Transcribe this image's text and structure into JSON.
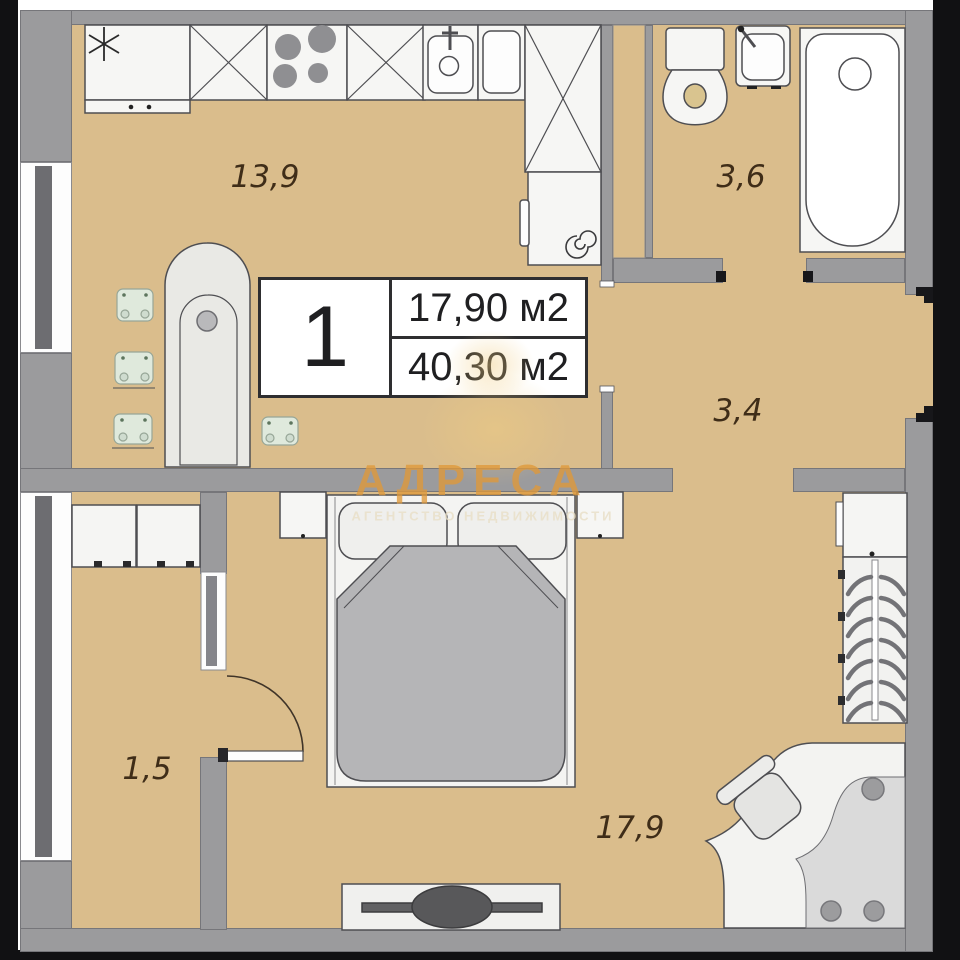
{
  "floor_plan": {
    "unit": {
      "rooms_count": "1",
      "living_area": "17,90 м2",
      "total_area": "40,30 м2"
    },
    "room_labels": {
      "kitchen": "13,9",
      "bathroom": "3,6",
      "hallway": "3,4",
      "balcony": "1,5",
      "bedroom": "17,9"
    },
    "watermark": {
      "title": "АДРЕСА",
      "subtitle": "АГЕНТСТВО НЕДВИЖИМОСТИ"
    },
    "colors": {
      "floor": "#dabd8c",
      "wall": "#9b9b9d",
      "watermark_accent": "#df983a"
    }
  }
}
